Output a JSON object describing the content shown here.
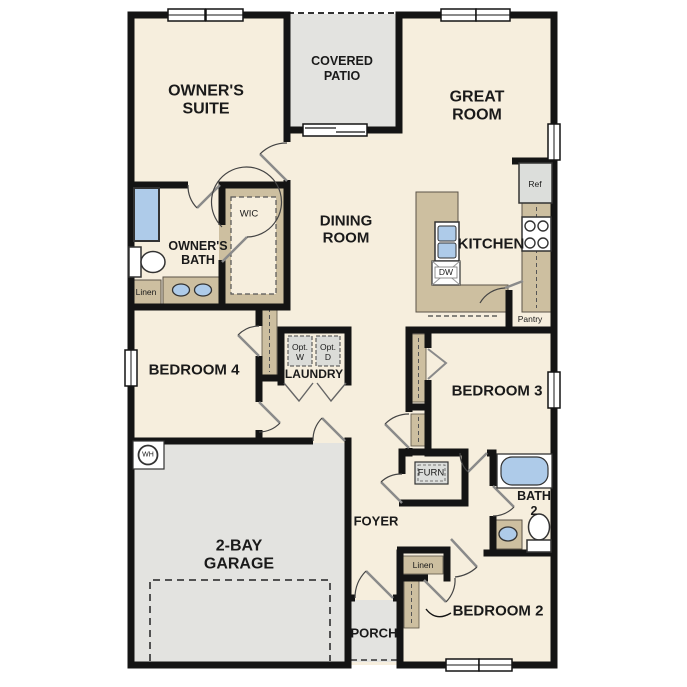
{
  "floor_plan": {
    "colors": {
      "wall": "#141414",
      "floor": "#f6eedd",
      "outdoor_gray": "#e3e3e0",
      "appliance_gray": "#dcdedb",
      "cabinet_tan": "#cdbfa0",
      "fixture_blue": "#aecbe9",
      "text": "#1a1a1a"
    },
    "rooms": {
      "owners_suite": {
        "label_line1": "OWNER'S",
        "label_line2": "SUITE"
      },
      "covered_patio": {
        "label_line1": "COVERED",
        "label_line2": "PATIO"
      },
      "great_room": {
        "label_line1": "GREAT",
        "label_line2": "ROOM"
      },
      "dining_room": {
        "label_line1": "DINING",
        "label_line2": "ROOM"
      },
      "owners_bath": {
        "label_line1": "OWNER'S",
        "label_line2": "BATH"
      },
      "wic": {
        "label": "WIC"
      },
      "kitchen": {
        "label": "KITCHEN"
      },
      "bedroom_4": {
        "label": "BEDROOM 4"
      },
      "laundry": {
        "label": "LAUNDRY"
      },
      "bedroom_3": {
        "label": "BEDROOM 3"
      },
      "garage": {
        "label_line1": "2-BAY",
        "label_line2": "GARAGE"
      },
      "foyer": {
        "label": "FOYER"
      },
      "bath_2": {
        "label_line1": "BATH",
        "label_line2": "2"
      },
      "bedroom_2": {
        "label": "BEDROOM 2"
      },
      "porch": {
        "label": "PORCH"
      }
    },
    "annotations": {
      "refrigerator": "Ref",
      "dishwasher": "DW",
      "pantry": "Pantry",
      "linen_owners_bath": "Linen",
      "linen_hall": "Linen",
      "optional_washer_line1": "Opt.",
      "optional_washer_line2": "W",
      "optional_dryer_line1": "Opt.",
      "optional_dryer_line2": "D",
      "furnace": "FURN",
      "water_heater": "WH"
    }
  }
}
